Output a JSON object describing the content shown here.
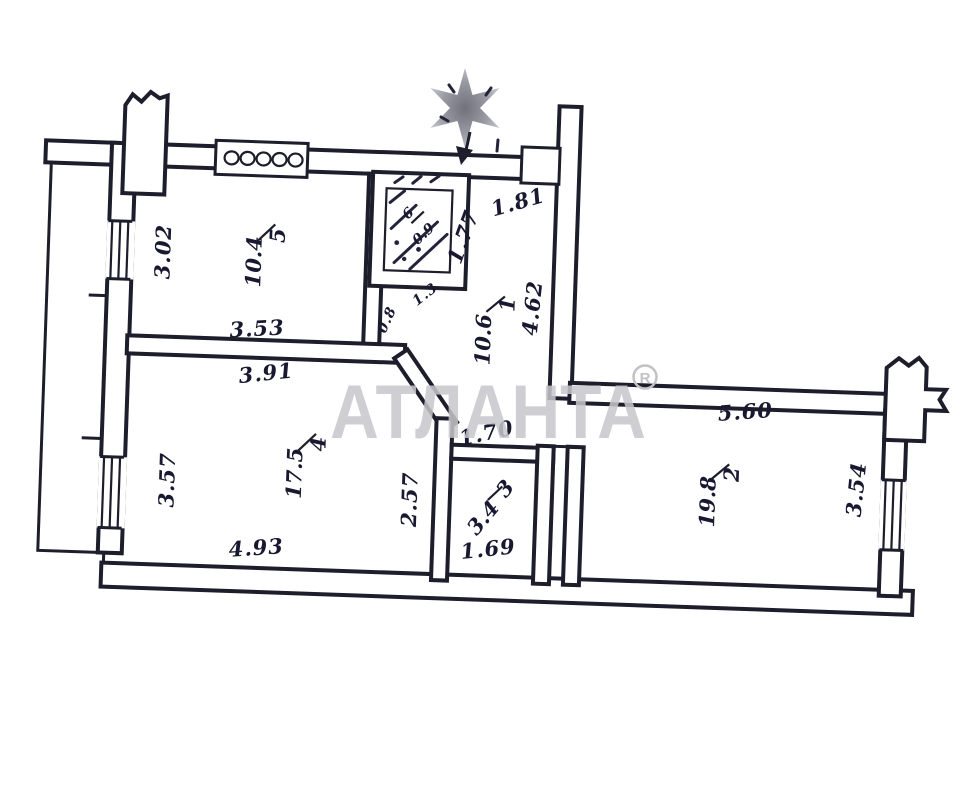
{
  "document": {
    "type": "apartment-floor-plan-scan"
  },
  "watermark": {
    "text": "АТЛАНТА",
    "registered_mark": "R",
    "color": "#c7c7cb"
  },
  "compass": {
    "symbol": "north-star"
  },
  "rooms": [
    {
      "number": "5",
      "area": "10.4"
    },
    {
      "number": "4",
      "area": "17.5"
    },
    {
      "number": "1",
      "area": "10.6"
    },
    {
      "number": "2",
      "area": "19.8"
    },
    {
      "number": "3",
      "area": "3.4"
    },
    {
      "number": "6",
      "area": "0.9"
    }
  ],
  "dimensions": [
    {
      "value": "3.02"
    },
    {
      "value": "3.53"
    },
    {
      "value": "3.91"
    },
    {
      "value": "3.57"
    },
    {
      "value": "4.93"
    },
    {
      "value": "2.57"
    },
    {
      "value": "1.3"
    },
    {
      "value": "0.8"
    },
    {
      "value": "1.77"
    },
    {
      "value": "1.81"
    },
    {
      "value": "4.62"
    },
    {
      "value": "1.70"
    },
    {
      "value": "1.69"
    },
    {
      "value": "5.60"
    },
    {
      "value": "3.54"
    }
  ]
}
